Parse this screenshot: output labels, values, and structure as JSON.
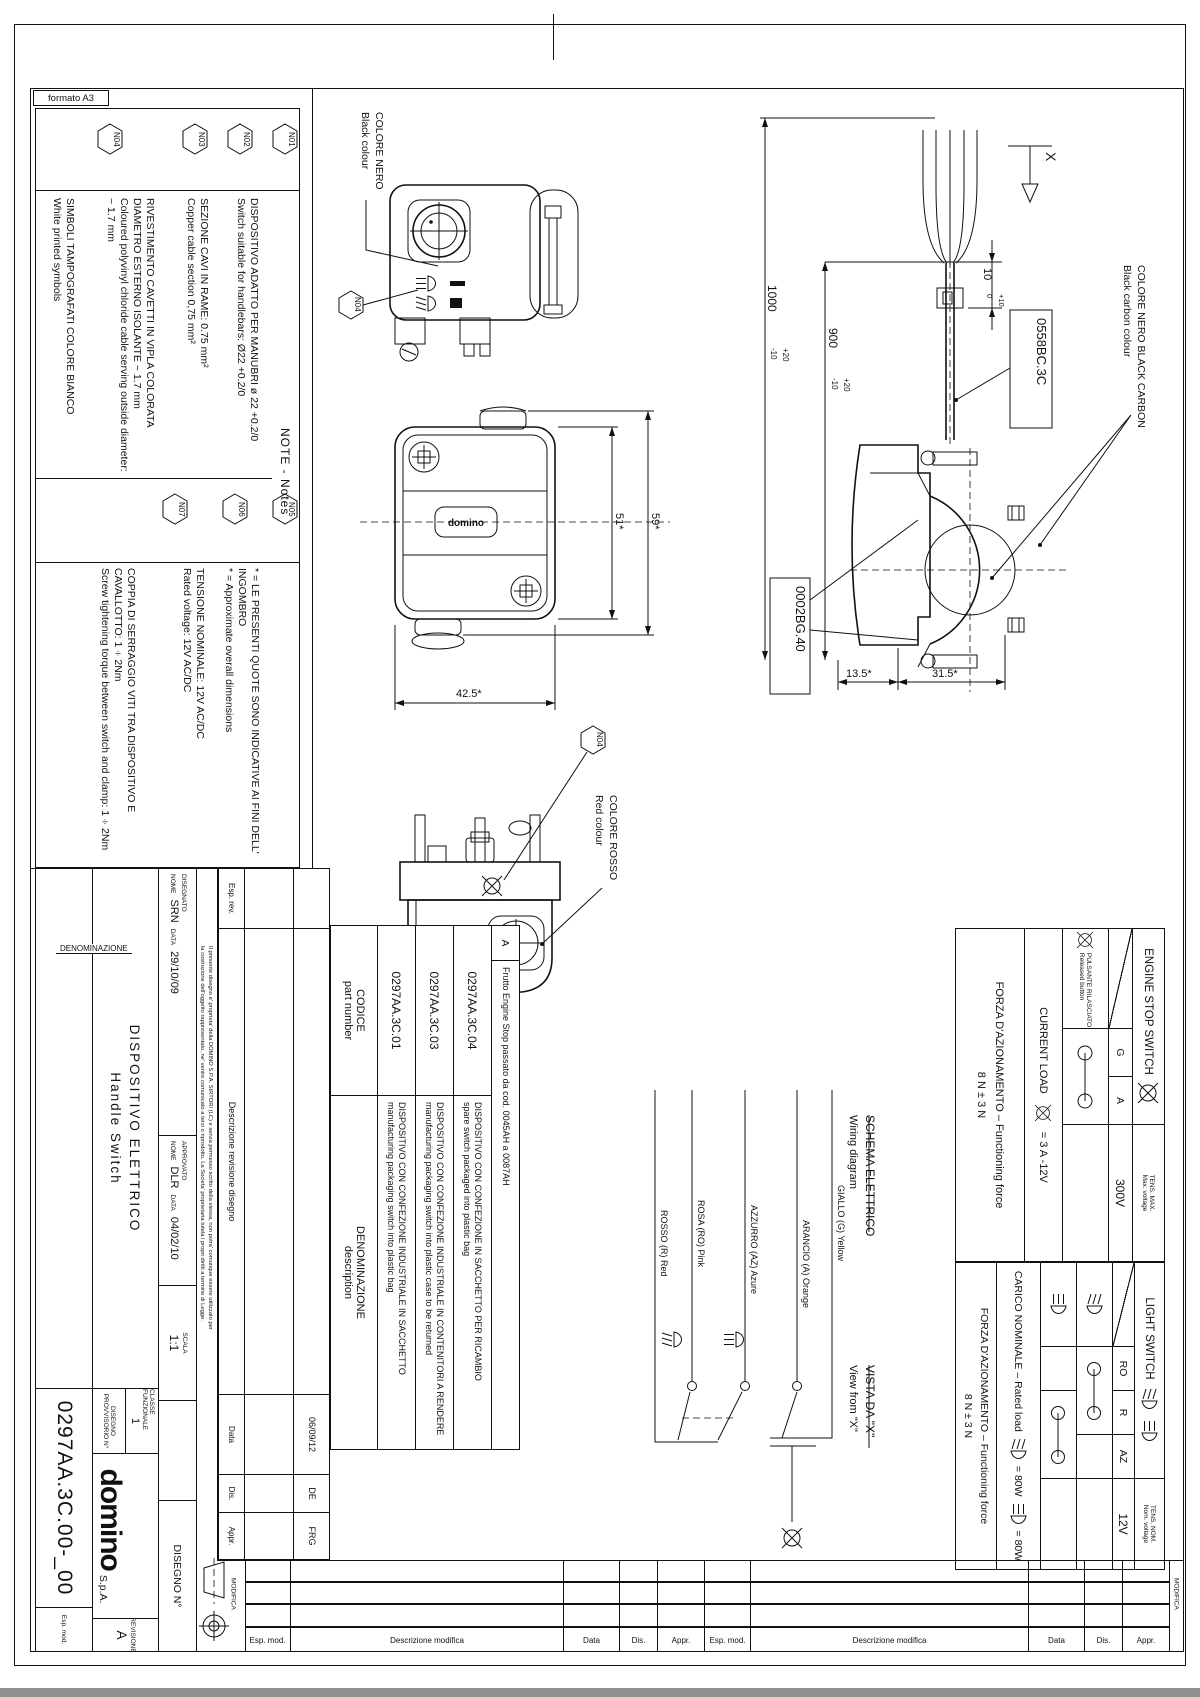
{
  "sheet": {
    "format_label": "formato A3",
    "company": "domino",
    "company_suffix": "S.p.A."
  },
  "notes": {
    "title": "NOTE  -  Notes",
    "items": [
      {
        "id": "N01",
        "it": "DISPOSITIVO ADATTO PER MANUBRI ø 22 +0.2/0",
        "en": "Switch suitable for handlebars: Ø22 +0.2/0"
      },
      {
        "id": "N02",
        "it": "SEZIONE CAVI IN RAME: 0.75 mm²",
        "en": "Copper cable section 0,75 mm²"
      },
      {
        "id": "N03",
        "it": "RIVESTIMENTO CAVETTI IN VIPLA COLORATA DIAMETRO ESTERNO ISOLANTE ~ 1.7 mm",
        "en": "Coloured polyvinyl chloride cable serving outside diameter: ~ 1.7 mm"
      },
      {
        "id": "N04",
        "it": "SIMBOLI TAMPOGRAFATI COLORE BIANCO",
        "en": "White printed symbols"
      },
      {
        "id": "N05",
        "it": "* = LE PRESENTI QUOTE SONO INDICATIVE AI FINI DELL' INGOMBRO",
        "en": "* = Approximate overall dimensions"
      },
      {
        "id": "N06",
        "it": "TENSIONE NOMINALE: 12V AC/DC",
        "en": "Rated voltage: 12V AC/DC"
      },
      {
        "id": "N07",
        "it": "COPPIA DI SERRAGGIO VITI TRA DISPOSITIVO E CAVALLOTTO: 1÷2Nm",
        "en": "Screw tightening torque between switch and clamp: 1÷2Nm"
      }
    ]
  },
  "callouts": {
    "black_colour_it": "COLORE NERO",
    "black_colour_en": "Black colour",
    "red_colour_it": "COLORE ROSSO",
    "red_colour_en": "Red colour",
    "black_carbon_it": "COLORE NERO BLACK CARBON",
    "black_carbon_en": "Black carbon colour",
    "cable_code": "0558BC.3C",
    "clamp_code": "0002BG.40",
    "view_letter": "X",
    "n04": "N04",
    "logo_on_part": "domino"
  },
  "dims": {
    "cable_total": "1000",
    "cable_total_up": "+20",
    "cable_total_dn": "-10",
    "sheath": "900",
    "sheath_up": "+20",
    "sheath_dn": "-10",
    "band": "10",
    "band_up": "+10",
    "band_dn": "0",
    "body_w": "42.5*",
    "body_h": "51*",
    "overall_h": "59*",
    "clamp_a": "13.5*",
    "clamp_b": "31.5*"
  },
  "wiring": {
    "title_it": "SCHEMA ELETTRICO",
    "title_en": "Wiring diagram",
    "view_it": "VISTA DA \"X\"",
    "view_en": "View from \"X\"",
    "wires": [
      {
        "label": "ROSSO (R) Red"
      },
      {
        "label": "ROSA (RO) Pink"
      },
      {
        "label": "AZZURRO (AZ) Azure"
      },
      {
        "label": "ARANCIO (A) Orange"
      },
      {
        "label": "GIALLO (G) Yellow"
      }
    ]
  },
  "engine_table": {
    "title": "ENGINE STOP SWITCH",
    "row_it": "PULSANTE RILASCIATO",
    "row_en": "Released button",
    "col1": "G",
    "col2": "A",
    "vmax_it": "TENS. MAX.",
    "vmax_en": "Max. voltage",
    "vmax": "300V",
    "load_label": "CURRENT LOAD",
    "load_value": "=  3 A  -12V",
    "force_it": "FORZA D'AZIONAMENTO – Functioning force",
    "force_value": "8 N ± 3 N"
  },
  "light_table": {
    "title": "LIGHT SWITCH",
    "col1": "RO",
    "col2": "R",
    "col3": "AZ",
    "vnom_it": "TENS. NOM.",
    "vnom_en": "Nom. voltage",
    "vnom": "12V",
    "load_label": "CARICO NOMINALE – Rated load",
    "load_hi": "=  80W",
    "load_lo": "=  80W",
    "force_it": "FORZA D'AZIONAMENTO – Functioning force",
    "force_value": "8 N ± 3 N"
  },
  "parts": {
    "code_h1": "CODICE",
    "code_h2": "part number",
    "desc_h1": "DENOMINAZIONE",
    "desc_h2": "description",
    "rev_letter": "A",
    "rev_desc": "Frutto Engine Stop passato da cod. 0045AH a 0087AH",
    "rows": [
      {
        "code": "0297AA.3C.04",
        "it": "DISPOSITIVO CON CONFEZIONE IN SACCHETTO PER RICAMBIO",
        "en": "spare switch packaged into plastic bag"
      },
      {
        "code": "0297AA.3C.03",
        "it": "DISPOSITIVO CON CONFEZIONE INDUSTRIALE IN CONTENITORI A RENDERE",
        "en": "manufacturing packaging switch into plastic case to be returned"
      },
      {
        "code": "0297AA.3C.01",
        "it": "DISPOSITIVO CON CONFEZIONE INDUSTRIALE IN SACCHETTO",
        "en": "manufacturing packaging switch into plastic bag"
      }
    ]
  },
  "modifica": {
    "label": "MODIFICA",
    "esp_rev": "Esp. rev.",
    "desc_label": "Descrizione revisione disegno",
    "data_h": "Data",
    "dis_h": "Dis.",
    "appr_h": "Appr.",
    "date": "06/09/12",
    "dis": "DE",
    "appr": "FRG"
  },
  "titleblock": {
    "denominazione": "DENOMINAZIONE",
    "name_it": "DISPOSITIVO ELETTRICO",
    "name_en": "Handle Switch",
    "disegnato": "DISEGNATO",
    "approvato": "APPROVATO",
    "nome": "NOME",
    "data": "DATA",
    "drawn_by": "SRN",
    "drawn_date": "29/10/09",
    "approved_by": "DLR",
    "approved_date": "04/02/10",
    "scala": "SCALA",
    "scale": "1:1",
    "classe_label": "CLASSE FUNZIONALE",
    "classe": "1",
    "prov_label": "DISEGNO PROVVISORIO N°",
    "rev_label": "REVISIONE",
    "rev": "A",
    "esp_mod": "Esp. mod.",
    "disegno_label": "DISEGNO N°",
    "number": "0297AA.3C.00-_00",
    "legal1": "Il presente disegno e' proprieta' della DOMINO S.P.A. SIRTORI (LC) e senza permesso scritto della stessa, non potra' comunque essere utilizzato per",
    "legal2": "la costruzione dell'oggetto rappresentato, ne' venire comunicato a terzi o riprodotto. La Societa' proprietaria tutela i propri diritti a termine di Legge."
  },
  "footer": {
    "esp_mod": "Esp. mod.",
    "descrizione": "Descrizione modifica",
    "data": "Data",
    "dis": "Dis.",
    "appr": "Appr.",
    "modifica": "MODIFICA"
  }
}
